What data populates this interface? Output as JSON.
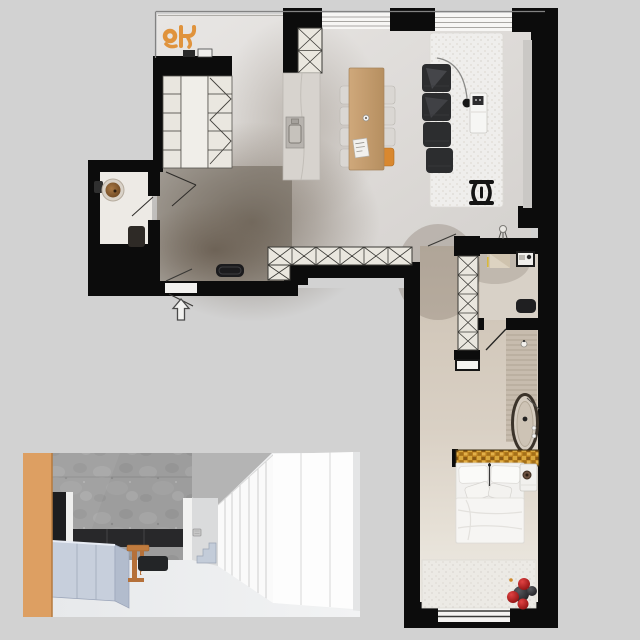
{
  "meta": {
    "kind": "apartment-floor-plan-render",
    "view": "top-down plan with perspective interior inset",
    "canvas": {
      "width": 640,
      "height": 640
    },
    "visible_text": "none"
  },
  "palette": {
    "bg": "#d2d2d2",
    "wall": "#0c0c0c",
    "cabinet": "#eae7df",
    "hatch": "#3b3a36",
    "chair": "#dad7d3",
    "wood": "#c59c6f",
    "accent": "#e0933c",
    "sofa": "#2c2d2f",
    "gold": "#c08a28",
    "red": "#c11e1e",
    "darksphere": "#3c3c3f",
    "io": "#dd9f62",
    "iconc": "#9d9d9d",
    "itv": "#28282a",
    "icab": "#c7cfdc",
    "istool": "#c07b3e",
    "isofa": "#232527",
    "isteps": "#c3ccd9"
  },
  "floor_plan": {
    "shape": "L-shaped apartment, living wing on top, bedroom wing down the right side",
    "rooms": [
      {
        "name": "entry-hall",
        "floor": "dark smoked oak",
        "items": [
          "entrance-door",
          "entry-arrow",
          "shoe-bench",
          "door-swing-lines"
        ]
      },
      {
        "name": "wc",
        "items": [
          "round-stone-basin",
          "wall-tap",
          "dark-toilet"
        ]
      },
      {
        "name": "wardrobe-closet",
        "items": [
          "shelf-column-left",
          "center-panel",
          "shelf-column-right",
          "hanging-rail-zigzag"
        ]
      },
      {
        "name": "kitchen",
        "items": [
          "tall-hatched-cabinet",
          "marble-counter",
          "cooktop",
          "counter-decor"
        ]
      },
      {
        "name": "living-dining",
        "items": [
          "orange-sculpture",
          "glazed-nook",
          "window-band-1",
          "window-band-2",
          "dining-table",
          "dining-chairs-white-x7",
          "dining-chair-orange",
          "table-cup",
          "table-magazine",
          "modular-sofa-4-seats",
          "arc-floor-lamp",
          "textured-rug",
          "coffee-table",
          "black-sculpture-chair",
          "small-floor-lamp",
          "curtain-strip",
          "low-hatched-sideboard-row"
        ]
      },
      {
        "name": "corridor",
        "items": [
          "hatched-wardrobe-column",
          "door-swing-line"
        ]
      },
      {
        "name": "study-nook",
        "items": [
          "tan-desk-wedge",
          "framed-desk-unit",
          "black-bench",
          "door-swing"
        ]
      },
      {
        "name": "bathroom",
        "items": [
          "freestanding-oval-tub",
          "tub-faucet",
          "tub-knobs",
          "pendant-bulb",
          "wall-basin",
          "decked-strip"
        ]
      },
      {
        "name": "bedroom",
        "items": [
          "gold-mosaic-headboard-strip",
          "double-bed-white",
          "pillows",
          "duvet",
          "nightstand",
          "cup-on-nightstand",
          "fluffy-rug",
          "red-spheres-x3",
          "dark-spheres-x2",
          "bottom-window"
        ]
      }
    ],
    "counts": {
      "dining_chairs_white": 7,
      "dining_chairs_orange": 1,
      "sofa_modules": 4,
      "sideboard_hatch_cells": 6,
      "column_hatch_cells": 5,
      "red_spheres": 3,
      "dark_spheres": 2
    }
  },
  "inset_render": {
    "position": "bottom-left",
    "view": "one-point perspective of living corridor",
    "items": [
      "orange-wood-panel",
      "concrete-feature-wall",
      "tv-media-band",
      "dark-doorway",
      "light-blue-kitchen-cabinets",
      "wood-stool",
      "dark-sofa-slab",
      "small-steps",
      "wall-switch",
      "glazing-strips",
      "white-closet-panels"
    ]
  }
}
